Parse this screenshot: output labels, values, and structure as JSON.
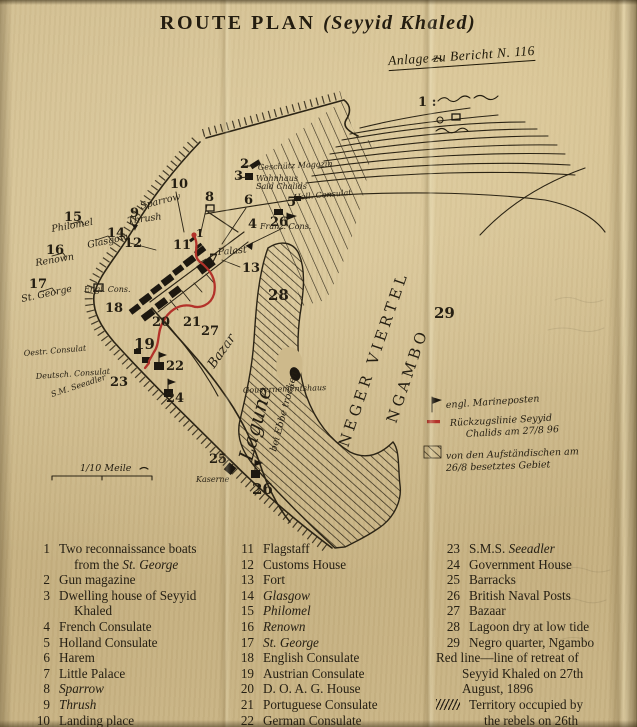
{
  "title": {
    "main": "ROUTE PLAN",
    "paren": "(Seyyid Khaled)",
    "note": "Anlage zu Bericht N. 116"
  },
  "colors": {
    "paper": "#cdb98b",
    "ink": "#2b2415",
    "red_line": "#b3322a"
  },
  "map": {
    "scale_label": "1/10 Meile",
    "scale_ratio_note": "1 :",
    "labels": [
      {
        "text": "1",
        "x": 196,
        "y": 237,
        "cls": "num-sm"
      },
      {
        "text": "2",
        "x": 240,
        "y": 168,
        "cls": "num"
      },
      {
        "text": "3",
        "x": 234,
        "y": 180,
        "cls": "num"
      },
      {
        "text": "4",
        "x": 248,
        "y": 228,
        "cls": "num"
      },
      {
        "text": "5",
        "x": 287,
        "y": 206,
        "cls": "num"
      },
      {
        "text": "6",
        "x": 244,
        "y": 204,
        "cls": "num"
      },
      {
        "text": "7",
        "x": 209,
        "y": 263,
        "cls": "num"
      },
      {
        "text": "8",
        "x": 205,
        "y": 201,
        "cls": "num"
      },
      {
        "text": "9",
        "x": 130,
        "y": 217,
        "cls": "num"
      },
      {
        "text": "10",
        "x": 170,
        "y": 188,
        "cls": "num"
      },
      {
        "text": "11",
        "x": 173,
        "y": 249,
        "cls": "num"
      },
      {
        "text": "12",
        "x": 124,
        "y": 247,
        "cls": "num"
      },
      {
        "text": "13",
        "x": 242,
        "y": 272,
        "cls": "num"
      },
      {
        "text": "14",
        "x": 107,
        "y": 237,
        "cls": "num"
      },
      {
        "text": "15",
        "x": 64,
        "y": 221,
        "cls": "num"
      },
      {
        "text": "16",
        "x": 46,
        "y": 254,
        "cls": "num"
      },
      {
        "text": "17",
        "x": 29,
        "y": 288,
        "cls": "num"
      },
      {
        "text": "18",
        "x": 105,
        "y": 312,
        "cls": "num"
      },
      {
        "text": "19",
        "x": 134,
        "y": 349,
        "cls": "num-lg"
      },
      {
        "text": "20",
        "x": 152,
        "y": 326,
        "cls": "num"
      },
      {
        "text": "21",
        "x": 183,
        "y": 326,
        "cls": "num"
      },
      {
        "text": "22",
        "x": 166,
        "y": 370,
        "cls": "num"
      },
      {
        "text": "23",
        "x": 110,
        "y": 386,
        "cls": "num"
      },
      {
        "text": "24",
        "x": 166,
        "y": 402,
        "cls": "num"
      },
      {
        "text": "25",
        "x": 209,
        "y": 463,
        "cls": "num"
      },
      {
        "text": "26",
        "x": 270,
        "y": 226,
        "cls": "num"
      },
      {
        "text": "26",
        "x": 252,
        "y": 494,
        "cls": "num-lg"
      },
      {
        "text": "27",
        "x": 201,
        "y": 335,
        "cls": "num"
      },
      {
        "text": "28",
        "x": 268,
        "y": 300,
        "cls": "num-lg"
      },
      {
        "text": "29",
        "x": 434,
        "y": 318,
        "cls": "num-lg"
      },
      {
        "text": "1 :",
        "x": 418,
        "y": 106,
        "cls": "num"
      },
      {
        "text": "Geschütz Magazin",
        "x": 258,
        "y": 170,
        "cls": "hw-sm",
        "rot": -3
      },
      {
        "text": "Wohnhaus",
        "x": 256,
        "y": 181,
        "cls": "hw-sm"
      },
      {
        "text": "Said Chalids",
        "x": 256,
        "y": 189,
        "cls": "hw-sm"
      },
      {
        "text": "Holl. Consulat",
        "x": 294,
        "y": 200,
        "cls": "hw-sm",
        "rot": -5
      },
      {
        "text": "Franz. Cons.",
        "x": 260,
        "y": 229,
        "cls": "hw-sm"
      },
      {
        "text": "Sparrow",
        "x": 141,
        "y": 209,
        "cls": "hw",
        "rot": -14
      },
      {
        "text": "Thrush",
        "x": 128,
        "y": 224,
        "cls": "hw",
        "rot": -8
      },
      {
        "text": "Glasgow",
        "x": 88,
        "y": 248,
        "cls": "hw",
        "rot": -12
      },
      {
        "text": "Philomel",
        "x": 52,
        "y": 232,
        "cls": "hw",
        "rot": -10
      },
      {
        "text": "Renown",
        "x": 36,
        "y": 266,
        "cls": "hw",
        "rot": -10
      },
      {
        "text": "St. George",
        "x": 22,
        "y": 302,
        "cls": "hw",
        "rot": -12
      },
      {
        "text": "Palast",
        "x": 218,
        "y": 255,
        "cls": "hw",
        "rot": -5
      },
      {
        "text": "Engl. Cons.",
        "x": 84,
        "y": 292,
        "cls": "hw-sm"
      },
      {
        "text": "Oestr. Consulat",
        "x": 24,
        "y": 356,
        "cls": "hw-sm",
        "rot": -5
      },
      {
        "text": "Deutsch. Consulat",
        "x": 36,
        "y": 379,
        "cls": "hw-sm",
        "rot": -4
      },
      {
        "text": "S.M. Seeadler",
        "x": 52,
        "y": 397,
        "cls": "hw-sm",
        "rot": -18
      },
      {
        "text": "Gouvernementshaus",
        "x": 243,
        "y": 393,
        "cls": "hw-sm",
        "rot": -2
      },
      {
        "text": "Kaserne",
        "x": 196,
        "y": 482,
        "cls": "hw-sm"
      },
      {
        "text": "Bazar",
        "x": 214,
        "y": 369,
        "cls": "hw-md",
        "rot": -55
      },
      {
        "text": "Lagune",
        "x": 252,
        "y": 462,
        "cls": "hw-lg",
        "rot": -75
      },
      {
        "text": "bei Ebbe trocken",
        "x": 276,
        "y": 452,
        "cls": "hw",
        "rot": -75
      },
      {
        "text": "NEGER VIERTEL",
        "x": 348,
        "y": 448,
        "cls": "district",
        "rot": -71
      },
      {
        "text": "NGAMBO",
        "x": 396,
        "y": 424,
        "cls": "district",
        "rot": -71
      },
      {
        "text": "engl. Marineposten",
        "x": 446,
        "y": 408,
        "cls": "note",
        "rot": -4
      },
      {
        "text": "Rückzugslinie Seyyid",
        "x": 450,
        "y": 426,
        "cls": "note",
        "rot": -3
      },
      {
        "text": "Chalids am 27/8 96",
        "x": 466,
        "y": 437,
        "cls": "note",
        "rot": -3
      },
      {
        "text": "von den Aufständischen am",
        "x": 446,
        "y": 459,
        "cls": "note",
        "rot": -2
      },
      {
        "text": "26/8 besetztes Gebiet",
        "x": 446,
        "y": 471,
        "cls": "note",
        "rot": -2
      },
      {
        "text": "1/10 Meile",
        "x": 80,
        "y": 471,
        "cls": "hw"
      }
    ]
  },
  "legend": {
    "columns": [
      [
        {
          "num": "1",
          "lines": [
            [
              {
                "t": "Two reconnaissance boats"
              }
            ],
            [
              {
                "t": "from the "
              },
              {
                "t": "St. George",
                "i": true
              }
            ]
          ]
        },
        {
          "num": "2",
          "lines": [
            [
              {
                "t": "Gun magazine"
              }
            ]
          ]
        },
        {
          "num": "3",
          "lines": [
            [
              {
                "t": "Dwelling house of Seyyid"
              }
            ],
            [
              {
                "t": "Khaled"
              }
            ]
          ]
        },
        {
          "num": "4",
          "lines": [
            [
              {
                "t": "French Consulate"
              }
            ]
          ]
        },
        {
          "num": "5",
          "lines": [
            [
              {
                "t": "Holland Consulate"
              }
            ]
          ]
        },
        {
          "num": "6",
          "lines": [
            [
              {
                "t": "Harem"
              }
            ]
          ]
        },
        {
          "num": "7",
          "lines": [
            [
              {
                "t": "Little Palace"
              }
            ]
          ]
        },
        {
          "num": "8",
          "lines": [
            [
              {
                "t": "Sparrow",
                "i": true
              }
            ]
          ]
        },
        {
          "num": "9",
          "lines": [
            [
              {
                "t": "Thrush",
                "i": true
              }
            ]
          ]
        },
        {
          "num": "10",
          "lines": [
            [
              {
                "t": "Landing place"
              }
            ]
          ]
        }
      ],
      [
        {
          "num": "11",
          "lines": [
            [
              {
                "t": "Flagstaff"
              }
            ]
          ]
        },
        {
          "num": "12",
          "lines": [
            [
              {
                "t": "Customs House"
              }
            ]
          ]
        },
        {
          "num": "13",
          "lines": [
            [
              {
                "t": "Fort"
              }
            ]
          ]
        },
        {
          "num": "14",
          "lines": [
            [
              {
                "t": "Glasgow",
                "i": true
              }
            ]
          ]
        },
        {
          "num": "15",
          "lines": [
            [
              {
                "t": "Philomel",
                "i": true
              }
            ]
          ]
        },
        {
          "num": "16",
          "lines": [
            [
              {
                "t": "Renown",
                "i": true
              }
            ]
          ]
        },
        {
          "num": "17",
          "lines": [
            [
              {
                "t": "St. George",
                "i": true
              }
            ]
          ]
        },
        {
          "num": "18",
          "lines": [
            [
              {
                "t": "English Consulate"
              }
            ]
          ]
        },
        {
          "num": "19",
          "lines": [
            [
              {
                "t": "Austrian Consulate"
              }
            ]
          ]
        },
        {
          "num": "20",
          "lines": [
            [
              {
                "t": "D. O. A. G. House"
              }
            ]
          ]
        },
        {
          "num": "21",
          "lines": [
            [
              {
                "t": "Portuguese Consulate"
              }
            ]
          ]
        },
        {
          "num": "22",
          "lines": [
            [
              {
                "t": "German Consulate"
              }
            ]
          ]
        }
      ],
      [
        {
          "num": "23",
          "lines": [
            [
              {
                "t": "S.M.S. "
              },
              {
                "t": "Seeadler",
                "i": true
              }
            ]
          ]
        },
        {
          "num": "24",
          "lines": [
            [
              {
                "t": "Government House"
              }
            ]
          ]
        },
        {
          "num": "25",
          "lines": [
            [
              {
                "t": "Barracks"
              }
            ]
          ]
        },
        {
          "num": "26",
          "lines": [
            [
              {
                "t": "British Naval Posts"
              }
            ]
          ]
        },
        {
          "num": "27",
          "lines": [
            [
              {
                "t": "Bazaar"
              }
            ]
          ]
        },
        {
          "num": "28",
          "lines": [
            [
              {
                "t": "Lagoon dry at low tide"
              }
            ]
          ]
        },
        {
          "num": "29",
          "lines": [
            [
              {
                "t": "Negro quarter, Ngambo"
              }
            ]
          ]
        },
        {
          "num": "",
          "flush": true,
          "lines": [
            [
              {
                "t": "Red line—line of retreat of"
              }
            ],
            [
              {
                "t": "Seyyid Khaled on 27th"
              }
            ],
            [
              {
                "t": "August, 1896"
              }
            ]
          ]
        },
        {
          "num": "",
          "glyph": "hatch",
          "lines": [
            [
              {
                "t": "Territory occupied by"
              }
            ],
            [
              {
                "t": "the rebels on 26th"
              }
            ],
            [
              {
                "t": "August, 1896"
              }
            ]
          ]
        }
      ]
    ]
  }
}
